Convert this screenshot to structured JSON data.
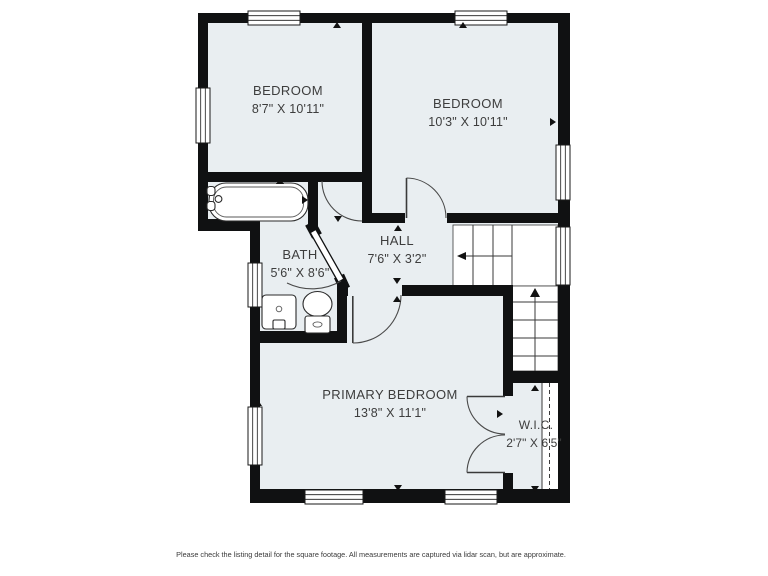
{
  "plan": {
    "type": "floor-plan",
    "rooms": {
      "bedroom1": {
        "name": "BEDROOM",
        "dims": "8'7\" X 10'11\""
      },
      "bedroom2": {
        "name": "BEDROOM",
        "dims": "10'3\" X 10'11\""
      },
      "bath": {
        "name": "BATH",
        "dims": "5'6\" X 8'6\""
      },
      "hall": {
        "name": "HALL",
        "dims": "7'6\" X 3'2\""
      },
      "primary": {
        "name": "PRIMARY BEDROOM",
        "dims": "13'8\" X 11'1\""
      },
      "wic": {
        "name": "W.I.C.",
        "dims": "2'7\" X 6'5\""
      }
    },
    "fixtures": [
      "bathtub-icon",
      "sink-icon",
      "toilet-icon",
      "stairs-icon"
    ]
  },
  "colors": {
    "wall": "#101112",
    "room_fill": "#e9eef1",
    "background": "#ffffff",
    "text": "#3d3d3d"
  },
  "footer": {
    "disclaimer": "Please check the listing detail for the square footage. All measurements are captured via lidar scan, but are approximate."
  }
}
